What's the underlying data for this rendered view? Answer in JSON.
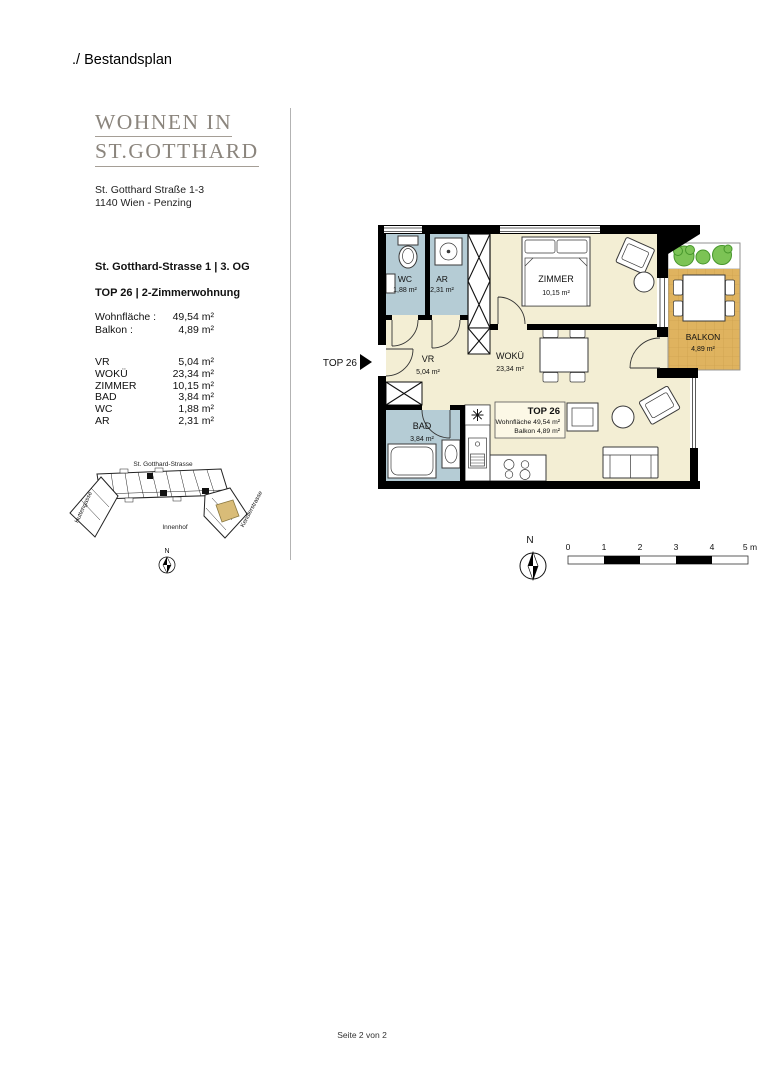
{
  "page": {
    "heading": "./ Bestandsplan",
    "footer": "Seite 2 von 2"
  },
  "brand": {
    "logo_line1": "WOHNEN IN",
    "logo_line2": "ST.GOTTHARD",
    "address_line1": "St. Gotthard Straße 1-3",
    "address_line2": "1140 Wien - Penzing"
  },
  "unit_info": {
    "location": "St. Gotthard-Strasse 1 | 3. OG",
    "unit": "TOP 26 | 2-Zimmerwohnung",
    "summary": [
      {
        "label": "Wohnfläche :",
        "value": "49,54 m²"
      },
      {
        "label": "Balkon :",
        "value": "4,89 m²"
      }
    ],
    "rooms": [
      {
        "label": "VR",
        "value": "5,04 m²"
      },
      {
        "label": "WOKÜ",
        "value": "23,34 m²"
      },
      {
        "label": "ZIMMER",
        "value": "10,15 m²"
      },
      {
        "label": "BAD",
        "value": "3,84 m²"
      },
      {
        "label": "WC",
        "value": "1,88 m²"
      },
      {
        "label": "AR",
        "value": "2,31 m²"
      }
    ]
  },
  "site_plan": {
    "street_top": "St. Gotthard-Strasse",
    "street_left": "Huttengasse",
    "street_right": "Kendlerstrasse",
    "courtyard": "Innenhof",
    "north_label": "N"
  },
  "floor_plan": {
    "entrance_label": "TOP 26",
    "rooms": {
      "wc": {
        "name": "WC",
        "area": "1,88 m²"
      },
      "ar": {
        "name": "AR",
        "area": "2,31 m²"
      },
      "zimmer": {
        "name": "ZIMMER",
        "area": "10,15 m²"
      },
      "vr": {
        "name": "VR",
        "area": "5,04 m²"
      },
      "woku": {
        "name": "WOKÜ",
        "area": "23,34 m²"
      },
      "bad": {
        "name": "BAD",
        "area": "3,84 m²"
      },
      "balkon": {
        "name": "BALKON",
        "area": "4,89 m²"
      }
    },
    "info_box": {
      "title": "TOP 26",
      "line1": "Wohnfläche 49,54 m²",
      "line2": "Balkon 4,89 m²"
    },
    "north_label": "N",
    "scale": {
      "labels": [
        "0",
        "1",
        "2",
        "3",
        "4",
        "5 m"
      ]
    }
  },
  "colors": {
    "room_cream": "#f3eed4",
    "room_blue": "#b5ccd5",
    "balcony_tile": "#dfb35f",
    "balcony_grid": "#c89c49",
    "plant_green": "#7cc355",
    "highlight_unit": "#d9bc78",
    "logo_gray": "#8b857d",
    "wall_black": "#000000"
  }
}
